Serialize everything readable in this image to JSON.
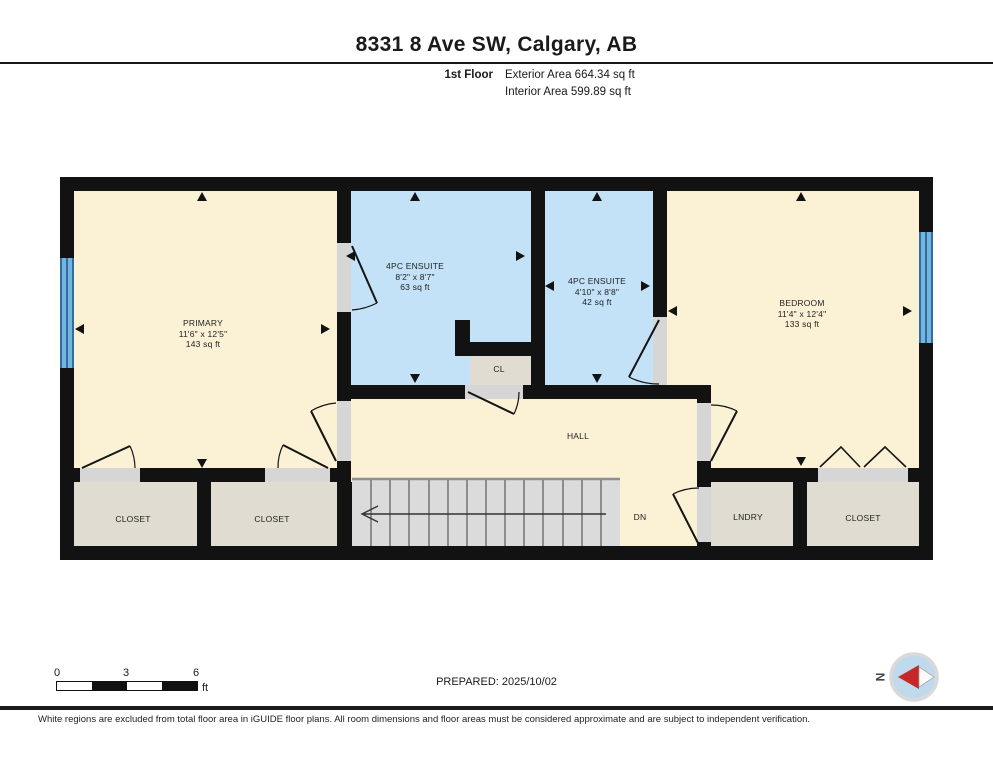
{
  "header": {
    "title": "8331 8 Ave SW, Calgary, AB",
    "floor_label": "1st Floor",
    "exterior_area": "Exterior Area 664.34 sq ft",
    "interior_area": "Interior Area 599.89 sq ft"
  },
  "rooms": {
    "primary": {
      "name": "PRIMARY",
      "dims": "11'6\" x 12'5\"",
      "area": "143 sq ft"
    },
    "ensuite1": {
      "name": "4PC ENSUITE",
      "dims": "8'2\" x 8'7\"",
      "area": "63 sq ft"
    },
    "ensuite2": {
      "name": "4PC ENSUITE",
      "dims": "4'10\" x 8'8\"",
      "area": "42 sq ft"
    },
    "bedroom": {
      "name": "BEDROOM",
      "dims": "11'4\" x 12'4\"",
      "area": "133 sq ft"
    },
    "cl": {
      "name": "CL"
    },
    "hall": {
      "name": "HALL"
    },
    "closet_left": {
      "name": "CLOSET"
    },
    "closet_mid": {
      "name": "CLOSET"
    },
    "laundry": {
      "name": "LNDRY"
    },
    "closet_right": {
      "name": "CLOSET"
    },
    "stairs": {
      "label": "DN"
    }
  },
  "scale_bar": {
    "ticks": [
      "0",
      "3",
      "6"
    ],
    "unit": "ft"
  },
  "footer": {
    "prepared": "PREPARED: 2025/10/02",
    "compass_label": "N",
    "disclaimer": "White regions are excluded from total floor area in iGUIDE floor plans. All room dimensions and floor areas must be considered approximate and are subject to independent verification."
  },
  "colors": {
    "room_cream": "#FBF1D5",
    "room_blue": "#C3E1F7",
    "closet_tan": "#E1DCD2",
    "stairs_grey": "#DBDBDB",
    "wall_black": "#121212",
    "door_sill": "#D6D6D6",
    "window_blue": "#74B4DE",
    "window_stripe": "#2F6E9E",
    "compass_red": "#C62828",
    "compass_circle": "#BFDAEC"
  }
}
